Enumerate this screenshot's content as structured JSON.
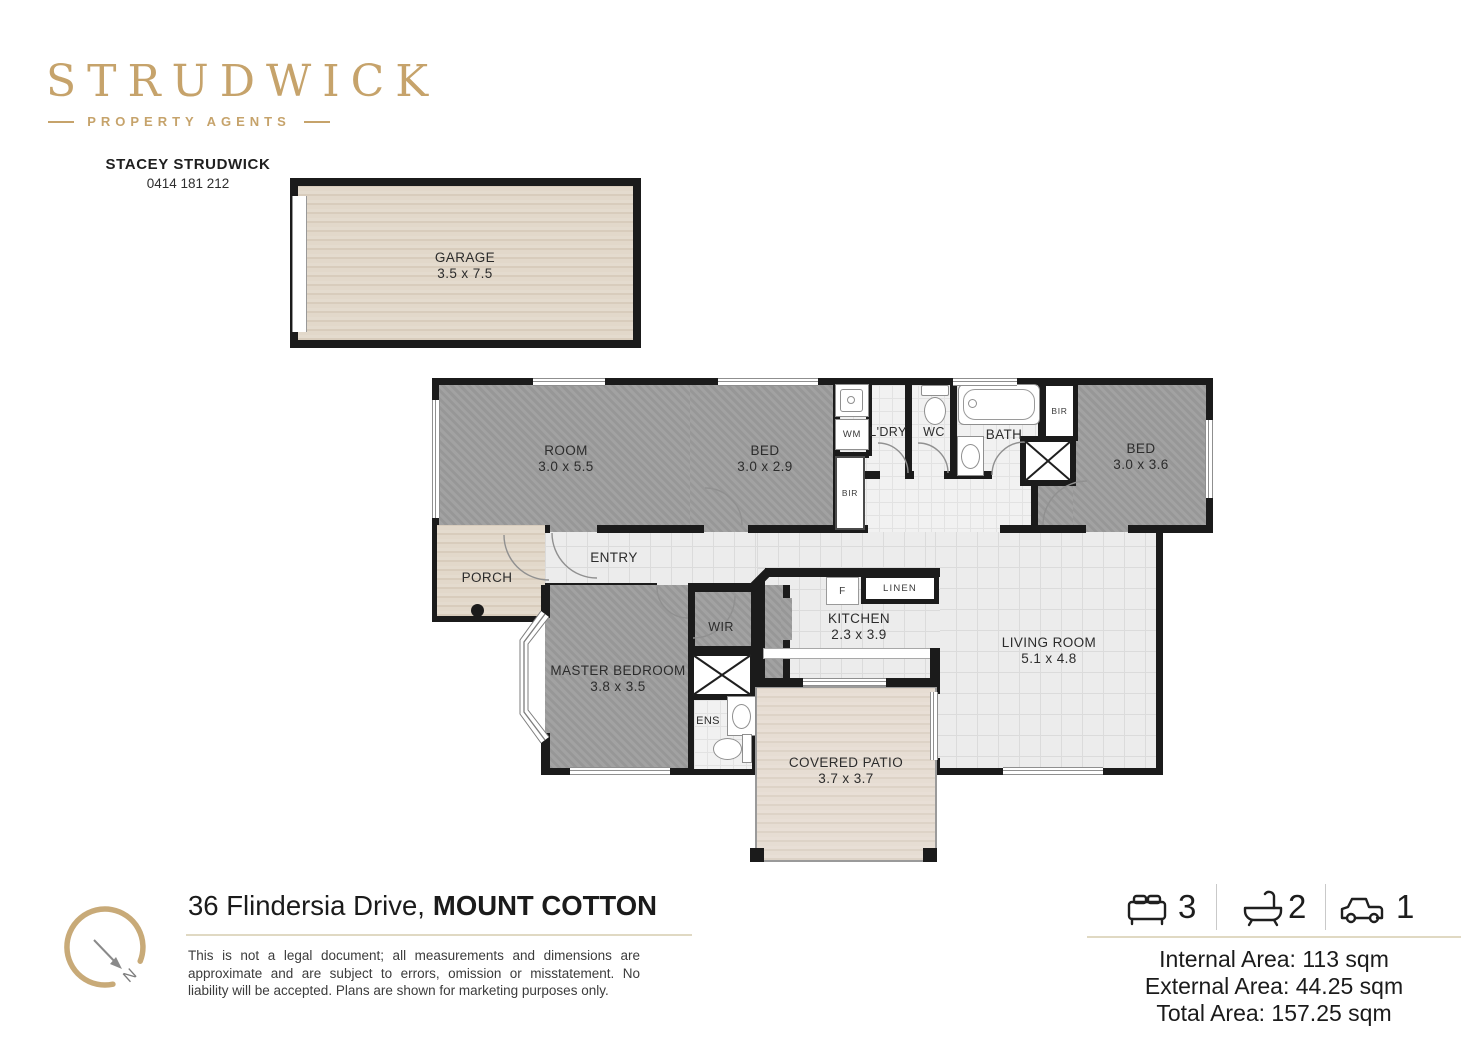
{
  "colors": {
    "gold": "#c6a36b",
    "wall": "#1b1b1b",
    "carpet": "#9d9d9d"
  },
  "brand": {
    "logo": "STRUDWICK",
    "tagline": "PROPERTY AGENTS",
    "agent_name": "STACEY STRUDWICK",
    "agent_phone": "0414 181 212"
  },
  "plan": {
    "garage": {
      "name": "GARAGE",
      "dims": "3.5 x 7.5"
    },
    "room": {
      "name": "ROOM",
      "dims": "3.0 x 5.5"
    },
    "bed_front": {
      "name": "BED",
      "dims": "3.0 x 2.9"
    },
    "wm": {
      "name": "WM"
    },
    "laundry": {
      "name": "L'DRY"
    },
    "wc": {
      "name": "WC"
    },
    "bath": {
      "name": "BATH"
    },
    "bir_hall": {
      "name": "BIR"
    },
    "bir_bed": {
      "name": "BIR"
    },
    "bed_rear": {
      "name": "BED",
      "dims": "3.0 x 3.6"
    },
    "porch": {
      "name": "PORCH"
    },
    "entry": {
      "name": "ENTRY"
    },
    "master": {
      "name": "MASTER BEDROOM",
      "dims": "3.8 x 3.5"
    },
    "wir": {
      "name": "WIR"
    },
    "ens": {
      "name": "ENS"
    },
    "fridge": {
      "name": "F"
    },
    "linen": {
      "name": "LINEN"
    },
    "kitchen": {
      "name": "KITCHEN",
      "dims": "2.3 x 3.9"
    },
    "living": {
      "name": "LIVING ROOM",
      "dims": "5.1 x 4.8"
    },
    "patio": {
      "name": "COVERED PATIO",
      "dims": "3.7 x 3.7"
    },
    "compass_letter": "N"
  },
  "footer": {
    "address_street": "36 Flindersia Drive,",
    "address_suburb": "MOUNT COTTON",
    "disclaimer_line1": "This is not a legal document; all measurements and dimensions are",
    "disclaimer_line2": "approximate and are subject to errors, omission or misstatement. No",
    "disclaimer_line3": "liability will be accepted. Plans are shown for marketing purposes only.",
    "stats": {
      "beds": "3",
      "baths": "2",
      "cars": "1"
    },
    "areas": {
      "internal": "Internal Area: 113 sqm",
      "external": "External Area: 44.25 sqm",
      "total": "Total Area: 157.25 sqm"
    }
  }
}
